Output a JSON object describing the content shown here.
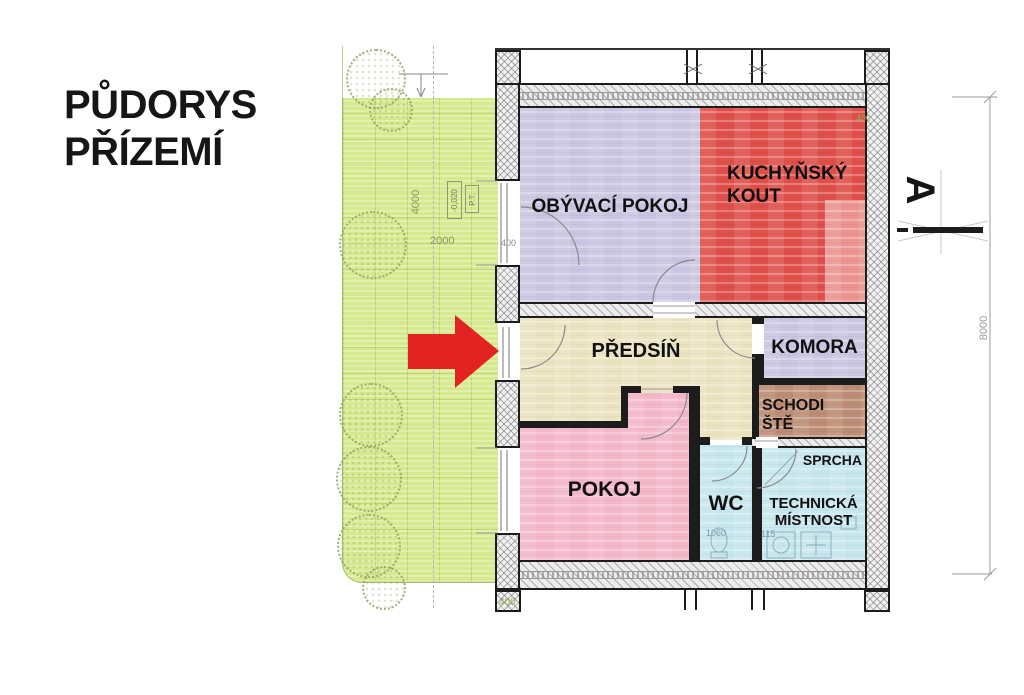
{
  "title": {
    "line1": "PŮDORYS",
    "line2": "PŘÍZEMÍ"
  },
  "plan": {
    "rooms": [
      {
        "id": "obyvaci-pokoj",
        "label": "OBÝVACÍ POKOJ",
        "color": "#cbc5e2"
      },
      {
        "id": "kuchynsky-kout",
        "label": "KUCHYŇSKÝ KOUT",
        "lines": [
          "KUCHYŇSKÝ",
          "KOUT"
        ],
        "color": "#df4f49"
      },
      {
        "id": "predsin",
        "label": "PŘEDSÍŇ",
        "color": "#ebe3c0"
      },
      {
        "id": "komora",
        "label": "KOMORA",
        "color": "#cbc5e2"
      },
      {
        "id": "schodiste",
        "label": "SCHODIŠTĚ",
        "lines": [
          "SCHODI",
          "ŠTĚ"
        ],
        "color": "#bc8d74"
      },
      {
        "id": "pokoj",
        "label": "POKOJ",
        "color": "#f4b7c9"
      },
      {
        "id": "wc",
        "label": "WC",
        "color": "#c5e6ed"
      },
      {
        "id": "technicka-mistnost",
        "label": "TECHNICKÁ MÍSTNOST",
        "lines": [
          "TECHNICKÁ",
          "MÍSTNOST"
        ],
        "color": "#c5e6ed"
      },
      {
        "id": "sprcha",
        "label": "SPRCHA",
        "color": "#c5e6ed"
      }
    ],
    "section_marker": {
      "label": "A"
    },
    "dimensions": {
      "building_height": "8000",
      "terrace_width": "4000",
      "terrace_length": "2000",
      "elevation": "-0,020",
      "terrain_mark": "P.T.",
      "wall_thickness": "400",
      "wc_width": "1060",
      "tech_dim": "115"
    }
  },
  "colors": {
    "terrace": "#d6e98c",
    "kitchen_light": "#eb9490",
    "arrow": "#e32222",
    "wall_line": "#1c1c1c"
  }
}
